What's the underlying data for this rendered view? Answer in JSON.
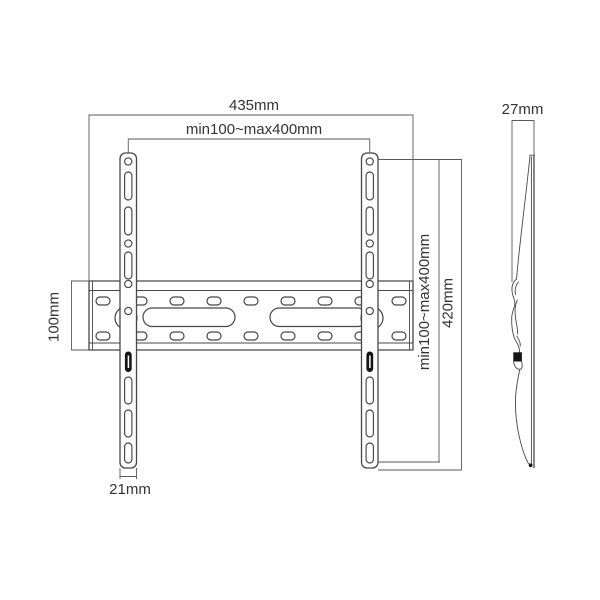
{
  "drawing": {
    "subject": "tv-wall-mount-dimension-diagram"
  },
  "colors": {
    "background": "#ffffff",
    "line": "#474747",
    "dimension_line": "#595959",
    "text": "#333333",
    "solid_fill": "#151515"
  },
  "dimensions": {
    "total_width": "435mm",
    "vesa_width_range": "min100~max400mm",
    "profile_depth": "27mm",
    "rail_height": "100mm",
    "vesa_height_range": "min100~max400mm",
    "bracket_height": "420mm",
    "bracket_width": "21mm"
  }
}
